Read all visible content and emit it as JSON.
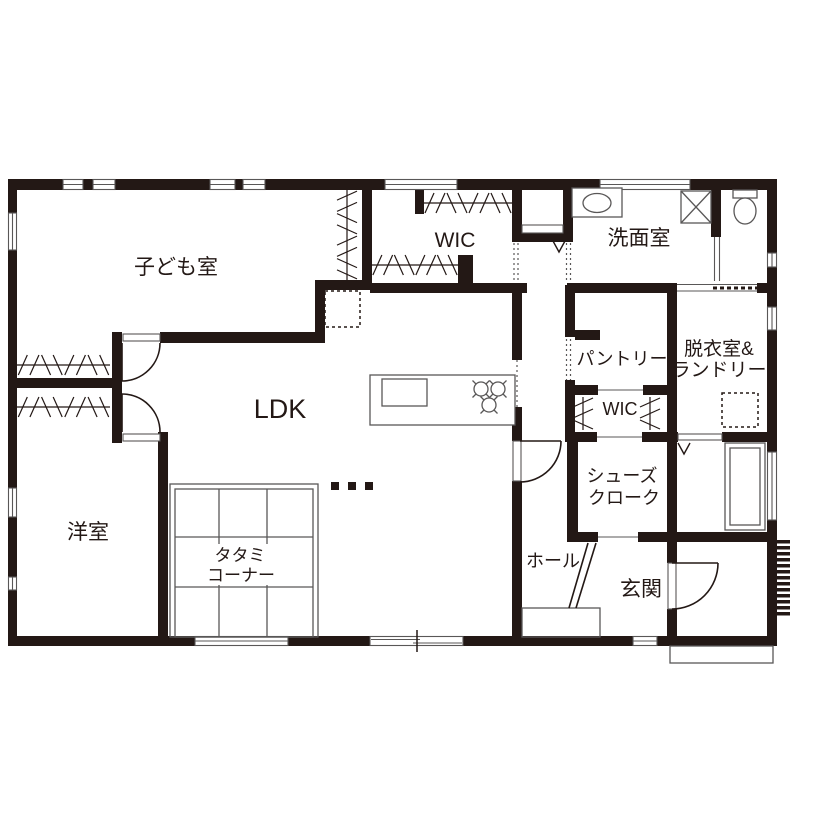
{
  "plan": {
    "title": "1F floor plan",
    "labels": {
      "kids_room": "子ども室",
      "wic_main": "WIC",
      "washroom": "洗面室",
      "pantry": "パントリー",
      "laundry_line1": "脱衣室&",
      "laundry_line2": "ランドリー",
      "ldk": "LDK",
      "wic_entrance": "WIC",
      "shoes_cloak_line1": "シューズ",
      "shoes_cloak_line2": "クローク",
      "western_room": "洋室",
      "tatami_line1": "タタミ",
      "tatami_line2": "コーナー",
      "hall": "ホール",
      "entrance": "玄関"
    },
    "colors": {
      "wall": "#231815",
      "fixture_line": "#595757",
      "background": "#ffffff"
    }
  }
}
